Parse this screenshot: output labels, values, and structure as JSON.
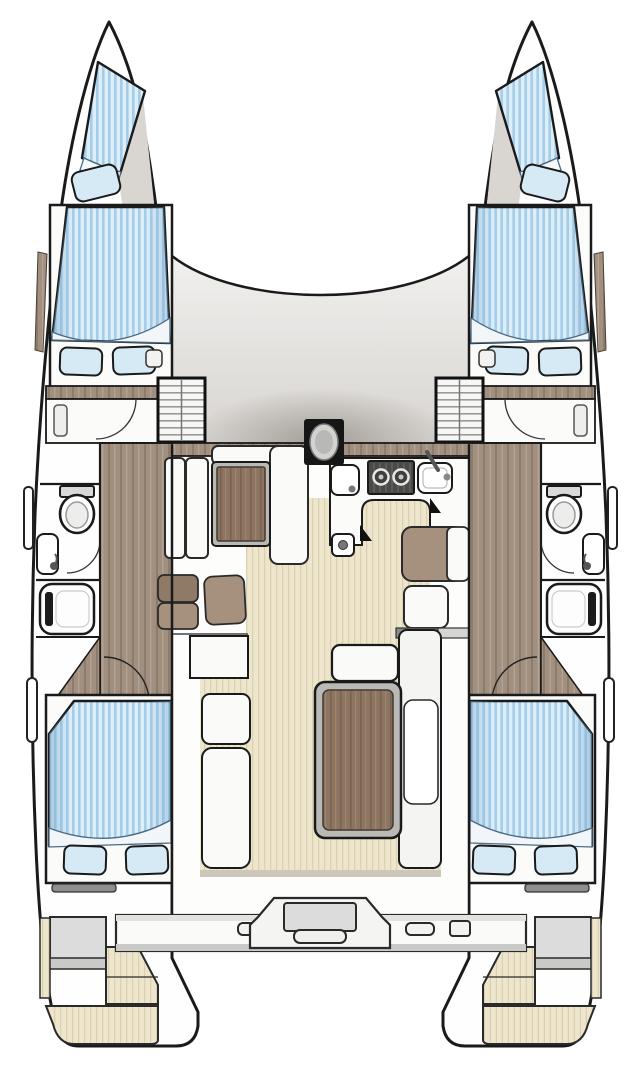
{
  "palette": {
    "background": "#ffffff",
    "outline": "#1a1a1a",
    "hull_fill": "#fefefe",
    "deck_gray_top": "#f1f0ee",
    "deck_gray_bottom": "#d7d4d0",
    "furniture_white": "#fafaf9",
    "mattress_blue_light": "#ddeef9",
    "mattress_blue_stripe": "#a3cde9",
    "pillow_blue": "#d6eaf6",
    "teak_cream": "#ede5cc",
    "teak_line": "#dbd1b2",
    "wood_brown": "#a18f7f",
    "wood_dark": "#8d7b6b",
    "table_wood": "#8d7563",
    "cushion_taupe": "#a5917e",
    "cushion_dark": "#8f7a68",
    "stove_dark": "#4a4a48",
    "hatch_gray": "#dcdcdc",
    "rail_gray": "#8e8e8c",
    "mast_black": "#161616",
    "table_frame_gray": "#b9b9b6",
    "sole_edge_gray": "#ccc7ba"
  },
  "boat": {
    "view": "top-down interior floor plan",
    "type": "sailing catamaran, 4 cabins / 2 heads",
    "port_hull": {
      "forepeak_berth": "single V-berth with pillow",
      "forward_cabin": "double berth with two pillows",
      "head": [
        "toilet",
        "wash basin",
        "door"
      ],
      "shower": "shower stall with grab handle",
      "companionway": "entry steps from saloon",
      "aft_cabin": "double berth with two pillows",
      "stern": [
        "grab rail",
        "storage hatch",
        "swim platform steps"
      ],
      "side_fittings": [
        "hull window trim",
        "boarding handle forward",
        "boarding handle aft",
        "deck cleat"
      ]
    },
    "starboard_hull": "mirror image of port hull",
    "bridge_deck": {
      "foredeck": "coachroof front edge between bows",
      "mast_step": "mast post on centerline",
      "saloon": {
        "settee": "L-shaped settee around wood table",
        "cushions": 4
      },
      "galley": [
        "sink",
        "two-burner stove",
        "prep sink with faucet",
        "under-counter locker"
      ],
      "cockpit": {
        "table": "rectangular wood cockpit table",
        "benches": 5
      },
      "transom": [
        "aft crossbeam",
        "central step / helm module with handle",
        "cleats"
      ]
    }
  }
}
